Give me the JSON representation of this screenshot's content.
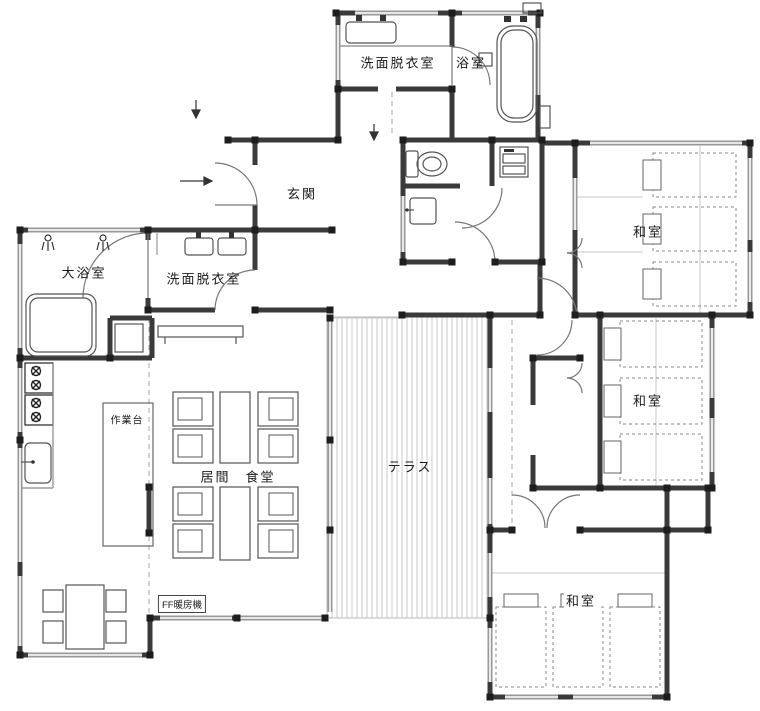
{
  "plan": {
    "labels": {
      "washroom_north": "洗面脱衣室",
      "bath_north": "浴室",
      "entrance": "玄関",
      "large_bath": "大浴室",
      "washroom_west": "洗面脱衣室",
      "work_counter": "作業台",
      "living_dining": "居間　食堂",
      "terrace": "テラス",
      "washitsu_ne": "和室",
      "washitsu_e": "和室",
      "washitsu_se": "和室",
      "ff_heater": "FF暖房機"
    },
    "colors": {
      "wall": "#3a3a3a",
      "window": "#999999",
      "fixture": "#555555",
      "hatch": "#c8c8c8",
      "text": "#1a1a1a"
    }
  }
}
